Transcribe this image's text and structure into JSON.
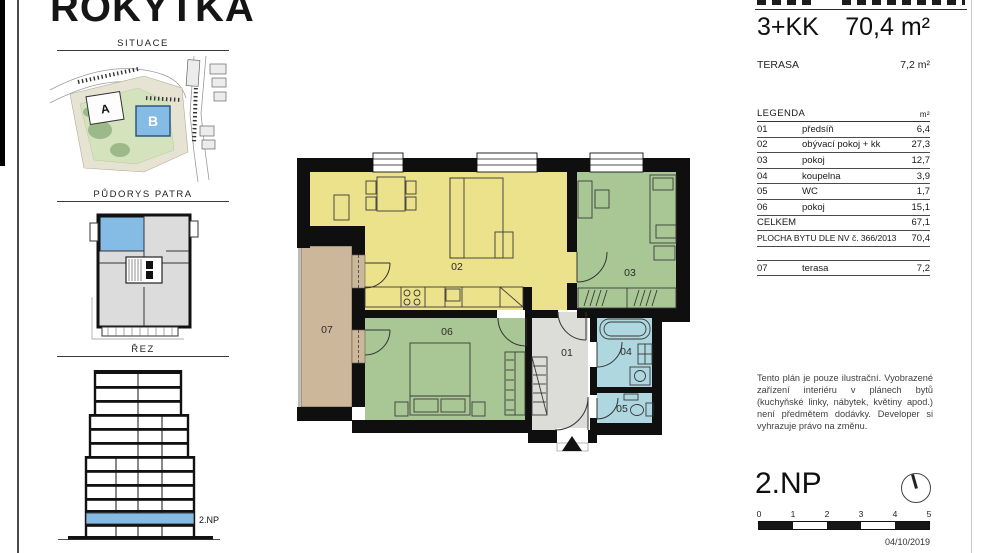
{
  "brand": {
    "logo": "ROKYTKA"
  },
  "sidebar": {
    "situace": {
      "label": "SITUACE",
      "building_a": "A",
      "building_b": "B"
    },
    "pudorys": {
      "label": "PŮDORYS PATRA"
    },
    "rez": {
      "label": "ŘEZ",
      "floor_label": "2.NP"
    }
  },
  "unit": {
    "layout": "3+KK",
    "area": "70,4 m²",
    "terrace_label": "TERASA",
    "terrace_area": "7,2 m²"
  },
  "legend": {
    "title": "LEGENDA",
    "unit_header": "m²",
    "rows": [
      {
        "num": "01",
        "name": "předsíň",
        "area": "6,4"
      },
      {
        "num": "02",
        "name": "obývací pokoj + kk",
        "area": "27,3"
      },
      {
        "num": "03",
        "name": "pokoj",
        "area": "12,7"
      },
      {
        "num": "04",
        "name": "koupelna",
        "area": "3,9"
      },
      {
        "num": "05",
        "name": "WC",
        "area": "1,7"
      },
      {
        "num": "06",
        "name": "pokoj",
        "area": "15,1"
      }
    ],
    "total_label": "CELKEM",
    "total_value": "67,1",
    "statute_label": "PLOCHA BYTU DLE NV č. 366/2013",
    "statute_value": "70,4",
    "terrace_row": {
      "num": "07",
      "name": "terasa",
      "area": "7,2"
    }
  },
  "plan": {
    "labels": {
      "r01": "01",
      "r02": "02",
      "r03": "03",
      "r04": "04",
      "r05": "05",
      "r06": "06",
      "r07": "07"
    },
    "colors": {
      "living": "#ece28b",
      "bedroom": "#a9c795",
      "bath": "#afd7df",
      "terrace": "#cdb79b",
      "hall": "#dcdcd8",
      "wall": "#0f0f0f",
      "highlight": "#85bce6"
    }
  },
  "disclaimer": "Tento plán je pouze ilustrační. Vyobrazené zařízení interiéru v plánech bytů (kuchyňské linky, nábytek, květiny apod.) není předmětem dodávky. Developer si vyhrazuje právo na změnu.",
  "footer": {
    "floor": "2.NP",
    "scale_ticks": [
      "0",
      "1",
      "2",
      "3",
      "4",
      "5"
    ],
    "date": "04/10/2019"
  }
}
